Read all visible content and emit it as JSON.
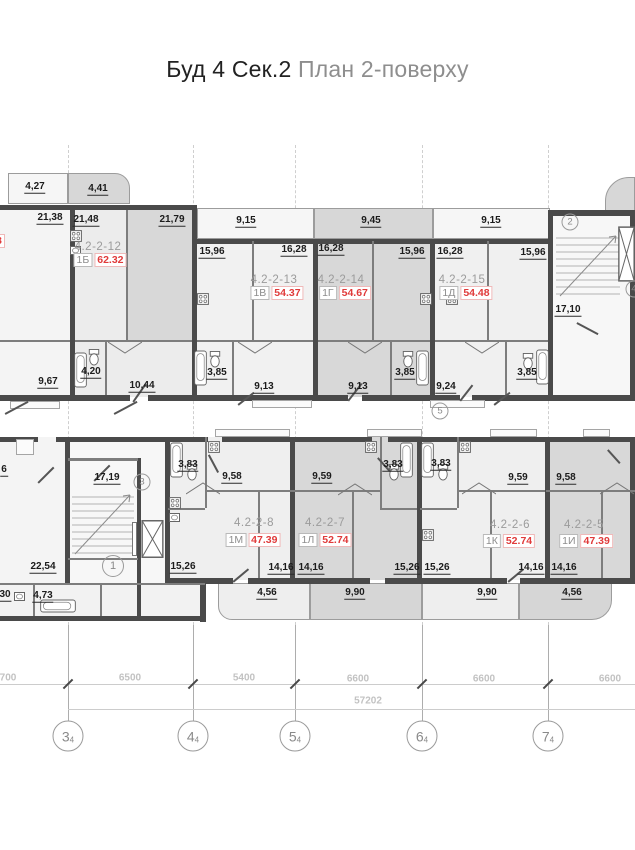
{
  "title": {
    "primary": "Буд 4 Сек.2",
    "secondary": " План 2-поверху"
  },
  "watermark": "НЕРУХОМІСТЬ",
  "upper": {
    "balcony_dims": [
      "4,27",
      "4,41",
      "9,15",
      "9,45",
      "9,15"
    ],
    "room_dims": [
      "21,38",
      "21,48",
      "21,79",
      "15,96",
      "16,28",
      "16,28",
      "15,96",
      "16,28",
      "15,96"
    ],
    "lower_dims": [
      "9,67",
      "4,20",
      "10,44",
      "3,85",
      "9,13",
      "9,13",
      "3,85",
      "9,24",
      "3,85"
    ],
    "stair_dim": "17,10",
    "apartments": [
      {
        "code": "4.2-2-12",
        "type": "1Б",
        "area": "62.32"
      },
      {
        "code": "4.2-2-13",
        "type": "1В",
        "area": "54.37"
      },
      {
        "code": "4.2-2-14",
        "type": "1Г",
        "area": "54.67"
      },
      {
        "code": "4.2-2-15",
        "type": "1Д",
        "area": "54.48"
      }
    ],
    "circles": {
      "stair": "2",
      "right": "4",
      "axis": "5"
    },
    "cut_fragment": "8"
  },
  "lower": {
    "top_dims": [
      "3,83",
      "9,58",
      "9,59",
      "3,83",
      "3,83",
      "9,59",
      "9,58"
    ],
    "room_dims": [
      "15,26",
      "14,16",
      "14,16",
      "15,26",
      "15,26",
      "14,16",
      "14,16"
    ],
    "balcony_dims": [
      "4,56",
      "9,90",
      "9,90",
      "4,56"
    ],
    "stair_dim": "17,19",
    "left_dims": {
      "hall": "22,54",
      "wc": "30",
      "bath": "4,73",
      "edge": "6"
    },
    "apartments": [
      {
        "code": "4.2-2-8",
        "type": "1М",
        "area": "47.39"
      },
      {
        "code": "4.2-2-7",
        "type": "1Л",
        "area": "52.74"
      },
      {
        "code": "4.2-2-6",
        "type": "1К",
        "area": "52.74"
      },
      {
        "code": "4.2-2-5",
        "type": "1И",
        "area": "47.39"
      }
    ],
    "circles": {
      "stair": "3",
      "hall": "1"
    }
  },
  "grid": {
    "segment_dims": [
      "700",
      "6500",
      "5400",
      "6600",
      "6600",
      "6600"
    ],
    "total_dim": "57202",
    "bubbles": [
      {
        "num": "3",
        "sub": "4"
      },
      {
        "num": "4",
        "sub": "4"
      },
      {
        "num": "5",
        "sub": "4"
      },
      {
        "num": "6",
        "sub": "4"
      },
      {
        "num": "7",
        "sub": "4"
      }
    ]
  }
}
